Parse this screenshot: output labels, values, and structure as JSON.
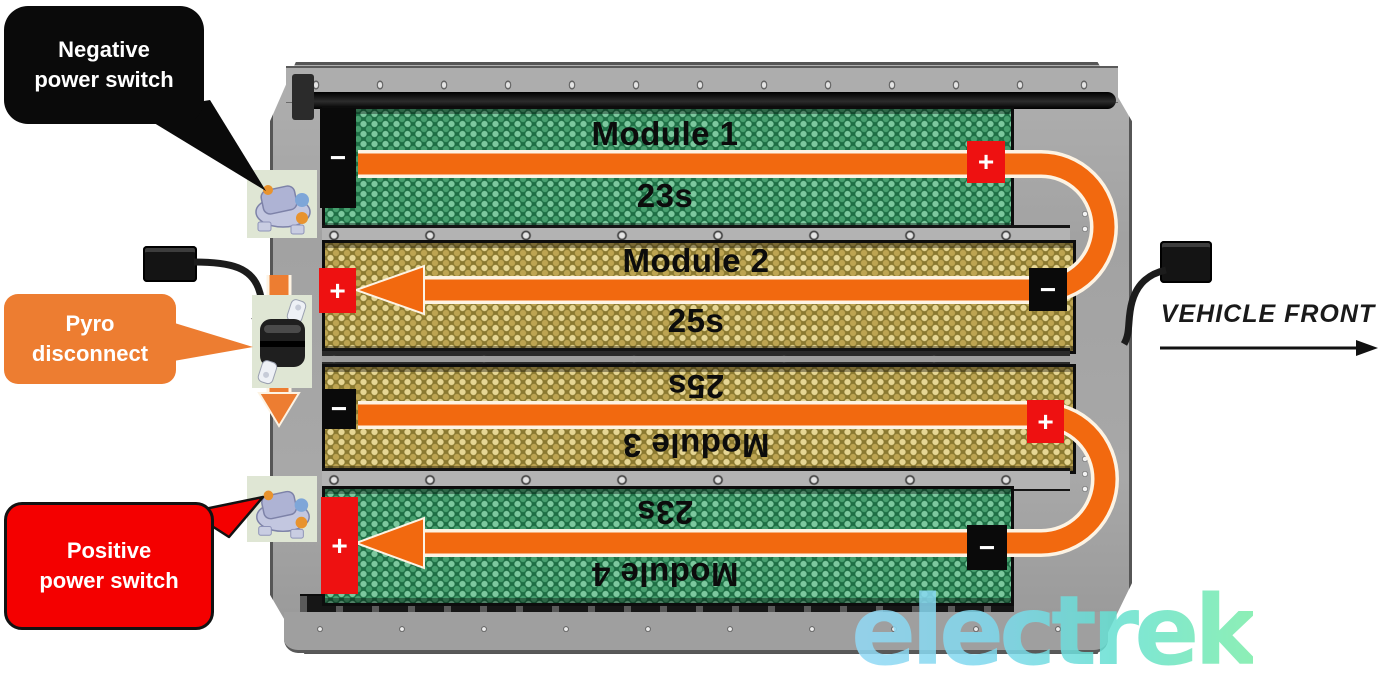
{
  "callouts": {
    "negative_power_switch": {
      "line1": "Negative",
      "line2": "power switch"
    },
    "pyro_disconnect": {
      "line1": "Pyro",
      "line2": "disconnect"
    },
    "positive_power_switch": {
      "line1": "Positive",
      "line2": "power switch"
    }
  },
  "modules": [
    {
      "name": "Module 1",
      "cells": "23s",
      "pattern": "green",
      "left_terminal": "−",
      "right_terminal": "+",
      "flow_direction": "left-to-right"
    },
    {
      "name": "Module 2",
      "cells": "25s",
      "pattern": "gold",
      "left_terminal": "+",
      "right_terminal": "−",
      "flow_direction": "right-to-left"
    },
    {
      "name": "Module 3",
      "cells": "25s",
      "pattern": "gold",
      "left_terminal": "−",
      "right_terminal": "+",
      "flow_direction": "left-to-right",
      "label_rotated": true
    },
    {
      "name": "Module 4",
      "cells": "23s",
      "pattern": "green",
      "left_terminal": "+",
      "right_terminal": "−",
      "flow_direction": "right-to-left",
      "label_rotated": true
    }
  ],
  "annotations": {
    "vehicle_front": "VEHICLE FRONT"
  },
  "watermark": {
    "text": "electrek"
  },
  "colors": {
    "flow_orange": "#f2690f",
    "callout_orange": "#ed7d31",
    "callout_red": "#f40000",
    "terminal_red": "#ee1111",
    "module_green": "#1e6f45",
    "module_gold": "#8a7930",
    "watermark_blue": "#93d9f6",
    "watermark_green": "#79eda9"
  }
}
